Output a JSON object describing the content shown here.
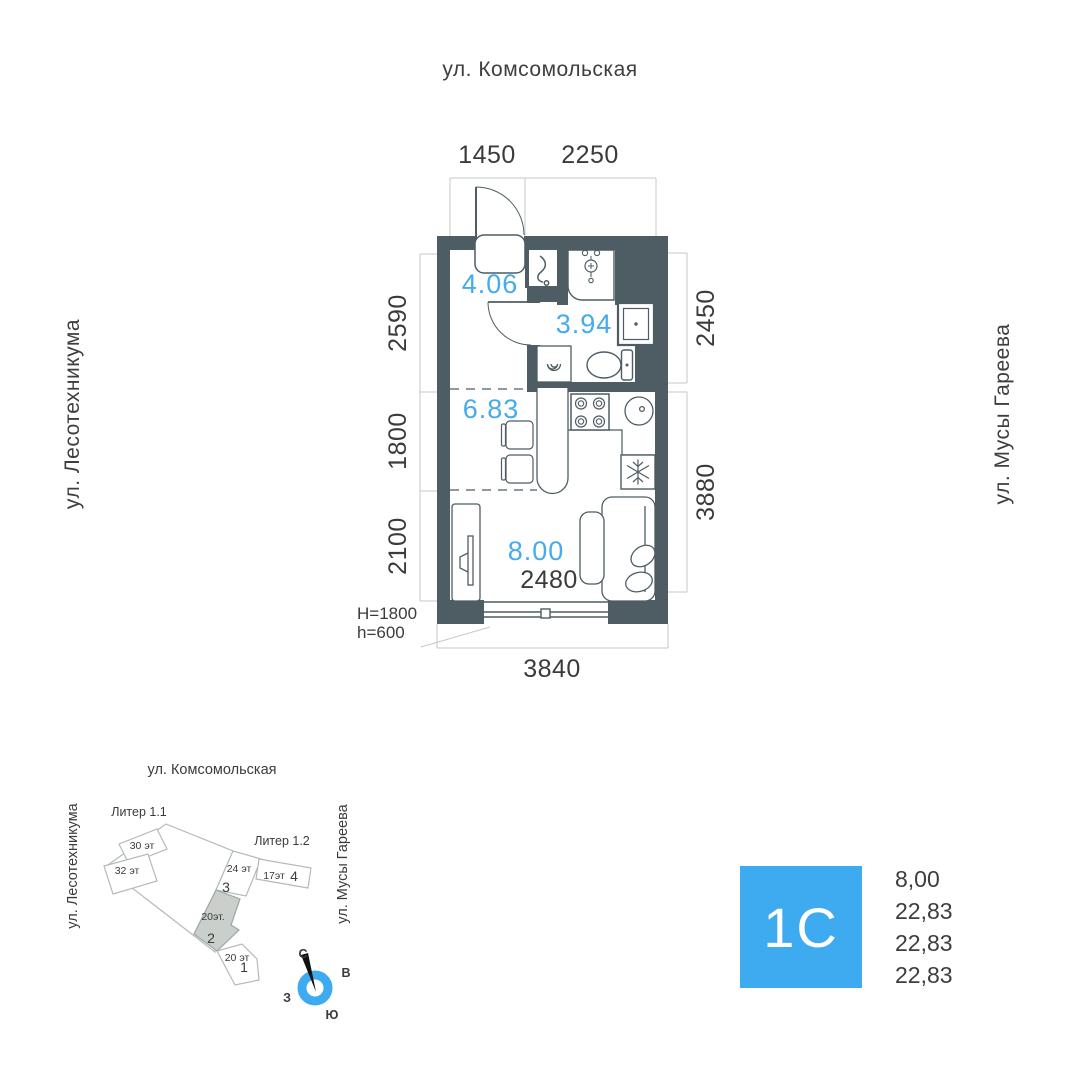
{
  "streets": {
    "top": "ул. Комсомольская",
    "left": "ул. Лесотехникума",
    "right": "ул. Мусы Гареева"
  },
  "plan": {
    "dim_top_1": "1450",
    "dim_top_2": "2250",
    "dim_left_1": "2590",
    "dim_left_2": "1800",
    "dim_left_3": "2100",
    "dim_right_1": "2450",
    "dim_right_2": "3880",
    "dim_bottom": "3840",
    "dim_inner": "2480",
    "area_hall": "4.06",
    "area_bath": "3.94",
    "area_kitchen": "6.83",
    "area_living": "8.00",
    "window_h": "H=1800",
    "window_sill": "h=600"
  },
  "siteplan": {
    "street_top": "ул. Комсомольская",
    "street_left": "ул. Лесотехникума",
    "street_right": "ул. Мусы Гареева",
    "liter_1": "Литер 1.1",
    "liter_2": "Литер 1.2",
    "b30": "30 эт",
    "b32": "32 эт",
    "b24": "24 эт",
    "b17": "17эт",
    "b20a": "20эт.",
    "b20b": "20 эт",
    "n1": "1",
    "n2": "2",
    "n3": "3",
    "n4": "4",
    "compass_n": "С",
    "compass_e": "В",
    "compass_s": "Ю",
    "compass_w": "З"
  },
  "legend": {
    "unit": "1С",
    "v1": "8,00",
    "v2": "22,83",
    "v3": "22,83",
    "v4": "22,83",
    "accent_color": "#3EAAEF"
  },
  "colors": {
    "wall": "#4E5D63",
    "area_label": "#45ACEC",
    "guide": "#c3c9cb"
  }
}
